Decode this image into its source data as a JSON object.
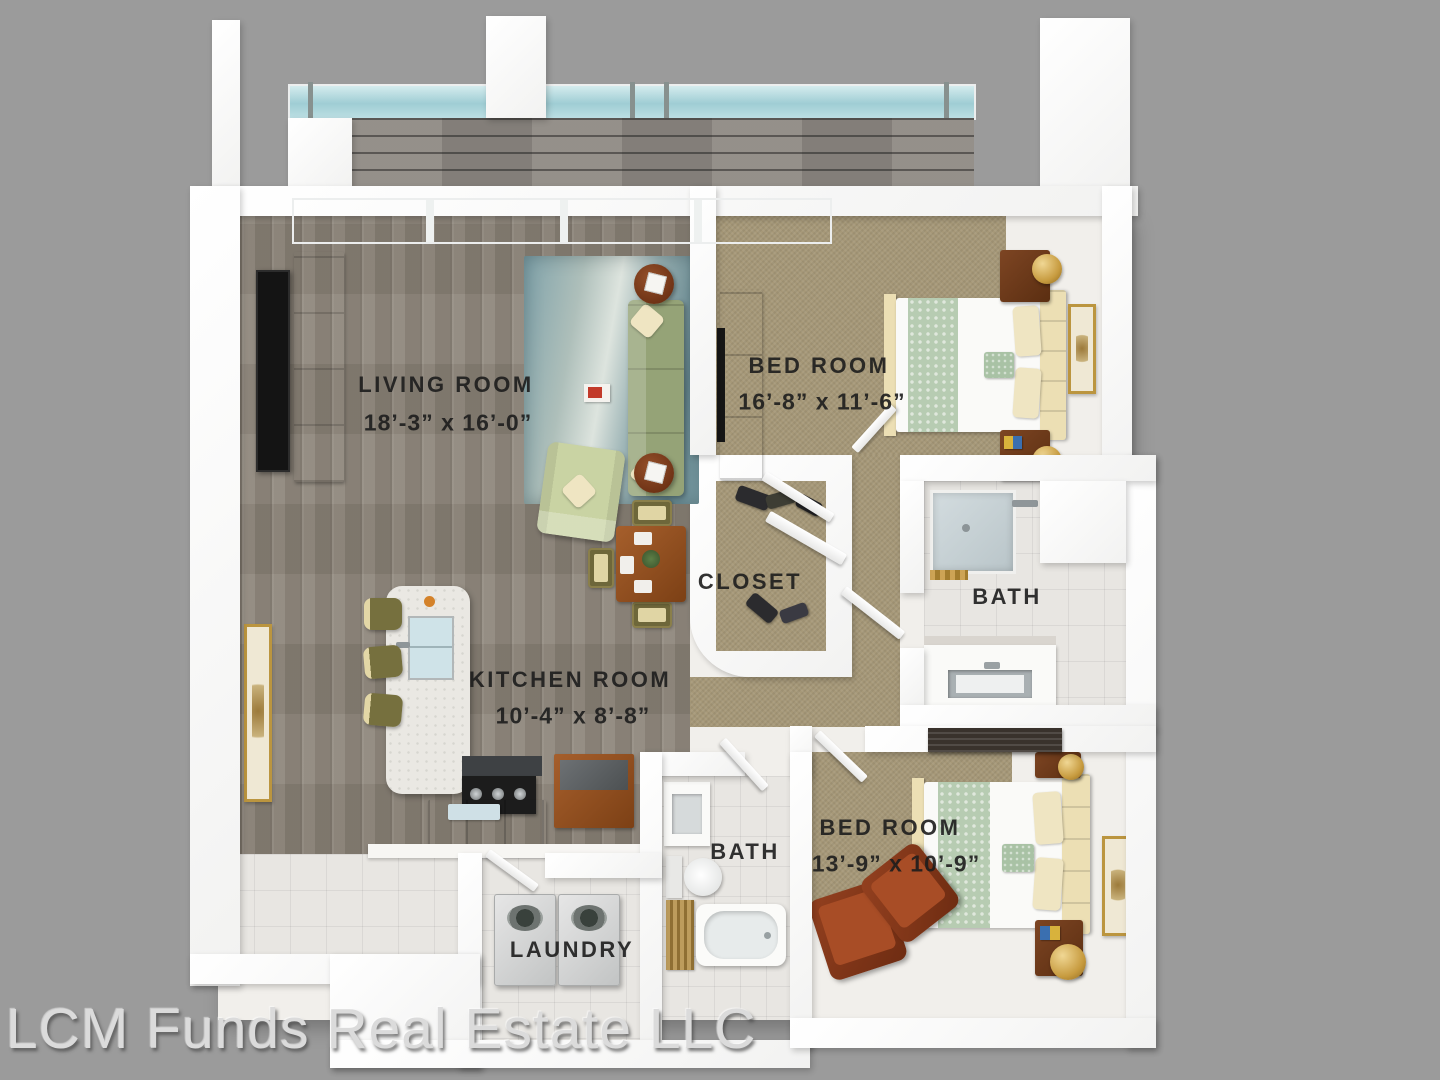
{
  "plan": {
    "watermark": "LCM Funds Real Estate LLC",
    "rooms": {
      "living": {
        "label": "LIVING  ROOM",
        "dims": "18’-3” x 16’-0”"
      },
      "bedroom1": {
        "label": "BED ROOM",
        "dims": "16’-8” x 11’-6”"
      },
      "closet": {
        "label": "CLOSET"
      },
      "bath1": {
        "label": "BATH"
      },
      "kitchen": {
        "label": "KITCHEN  ROOM",
        "dims": "10’-4” x 8’-8”"
      },
      "bath2": {
        "label": "BATH"
      },
      "bedroom2": {
        "label": "BED ROOM",
        "dims": "13’-9” x 10’-9”"
      },
      "laundry": {
        "label": "LAUNDRY"
      }
    },
    "colors": {
      "background": "#9b9b9b",
      "wall": "#ffffff",
      "wood_floor": "#8b8378",
      "carpet": "#a69878",
      "tile": "#e8e6e2",
      "rug": "#7fa2aa",
      "sofa": "#95a377",
      "cabinet_wood": "#9a5526",
      "glass": "#a7d2d8",
      "label_text": "#1d1d1d",
      "watermark_text": "#dbdbdb"
    }
  }
}
